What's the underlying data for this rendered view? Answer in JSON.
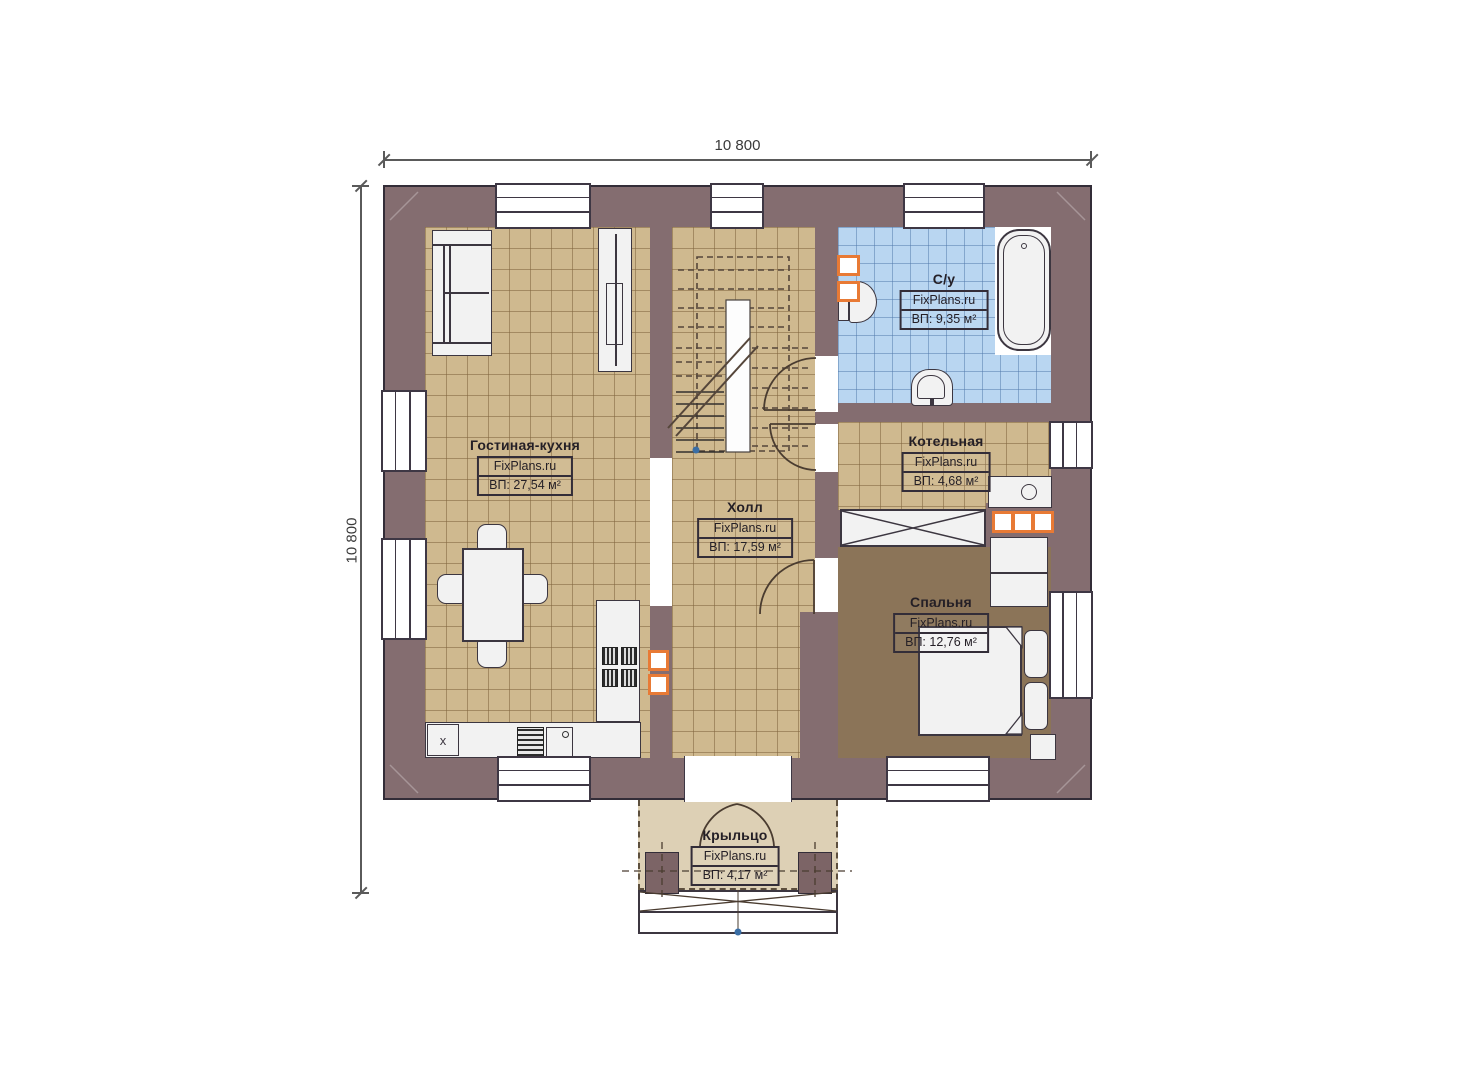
{
  "dimensions": {
    "top": "10 800",
    "left": "10 800"
  },
  "rooms": [
    {
      "name": "Гостиная-кухня",
      "brand": "FixPlans.ru",
      "area": "ВП: 27,54 м²"
    },
    {
      "name": "Холл",
      "brand": "FixPlans.ru",
      "area": "ВП: 17,59 м²"
    },
    {
      "name": "С/у",
      "brand": "FixPlans.ru",
      "area": "ВП: 9,35 м²"
    },
    {
      "name": "Котельная",
      "brand": "FixPlans.ru",
      "area": "ВП: 4,68 м²"
    },
    {
      "name": "Спальня",
      "brand": "FixPlans.ru",
      "area": "ВП: 12,76 м²"
    },
    {
      "name": "Крыльцо",
      "brand": "FixPlans.ru",
      "area": "ВП: 4,17 м²"
    }
  ],
  "kitchen": {
    "corner_mark": "x"
  },
  "colors": {
    "wall": "#846d70",
    "floor_tan": "#cfb98f",
    "floor_blue": "#b9d6f1",
    "floor_bedroom": "#8b7458",
    "floor_porch": "#ddd0b5",
    "accent_orange": "#e87a35"
  }
}
